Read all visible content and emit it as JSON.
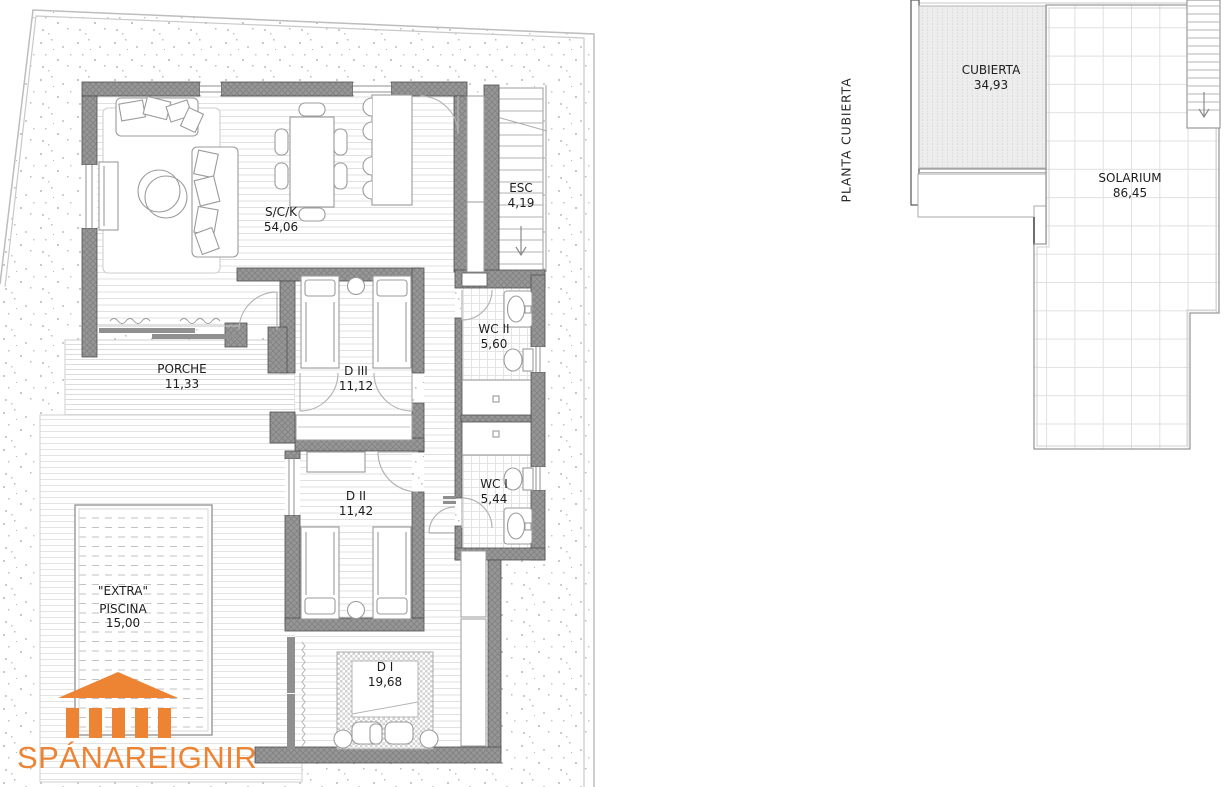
{
  "colors": {
    "wall_gray": "#969696",
    "line_gray": "#9b9b9b",
    "accent_orange": "#ec8434"
  },
  "logo": {
    "text": "SPÁNAREIGNIR",
    "icon": "temple-icon"
  },
  "floor_plan": {
    "name": "ground-floor-plan",
    "rooms": [
      {
        "id": "sck",
        "name": "S/C/K",
        "area": "54,06"
      },
      {
        "id": "esc",
        "name": "ESC",
        "area": "4,19"
      },
      {
        "id": "wc2",
        "name": "WC II",
        "area": "5,60"
      },
      {
        "id": "d3",
        "name": "D III",
        "area": "11,12"
      },
      {
        "id": "porche",
        "name": "PORCHE",
        "area": "11,33"
      },
      {
        "id": "d2",
        "name": "D II",
        "area": "11,42"
      },
      {
        "id": "wc1",
        "name": "WC I",
        "area": "5,44"
      },
      {
        "id": "extra",
        "name": "\"EXTRA\"",
        "sub": "PISCINA",
        "area": "15,00"
      },
      {
        "id": "d1",
        "name": "D I",
        "area": "19,68"
      }
    ]
  },
  "roof_plan": {
    "title": "PLANTA CUBIERTA",
    "rooms": [
      {
        "id": "cubierta",
        "name": "CUBIERTA",
        "area": "34,93"
      },
      {
        "id": "solarium",
        "name": "SOLARIUM",
        "area": "86,45"
      }
    ]
  }
}
